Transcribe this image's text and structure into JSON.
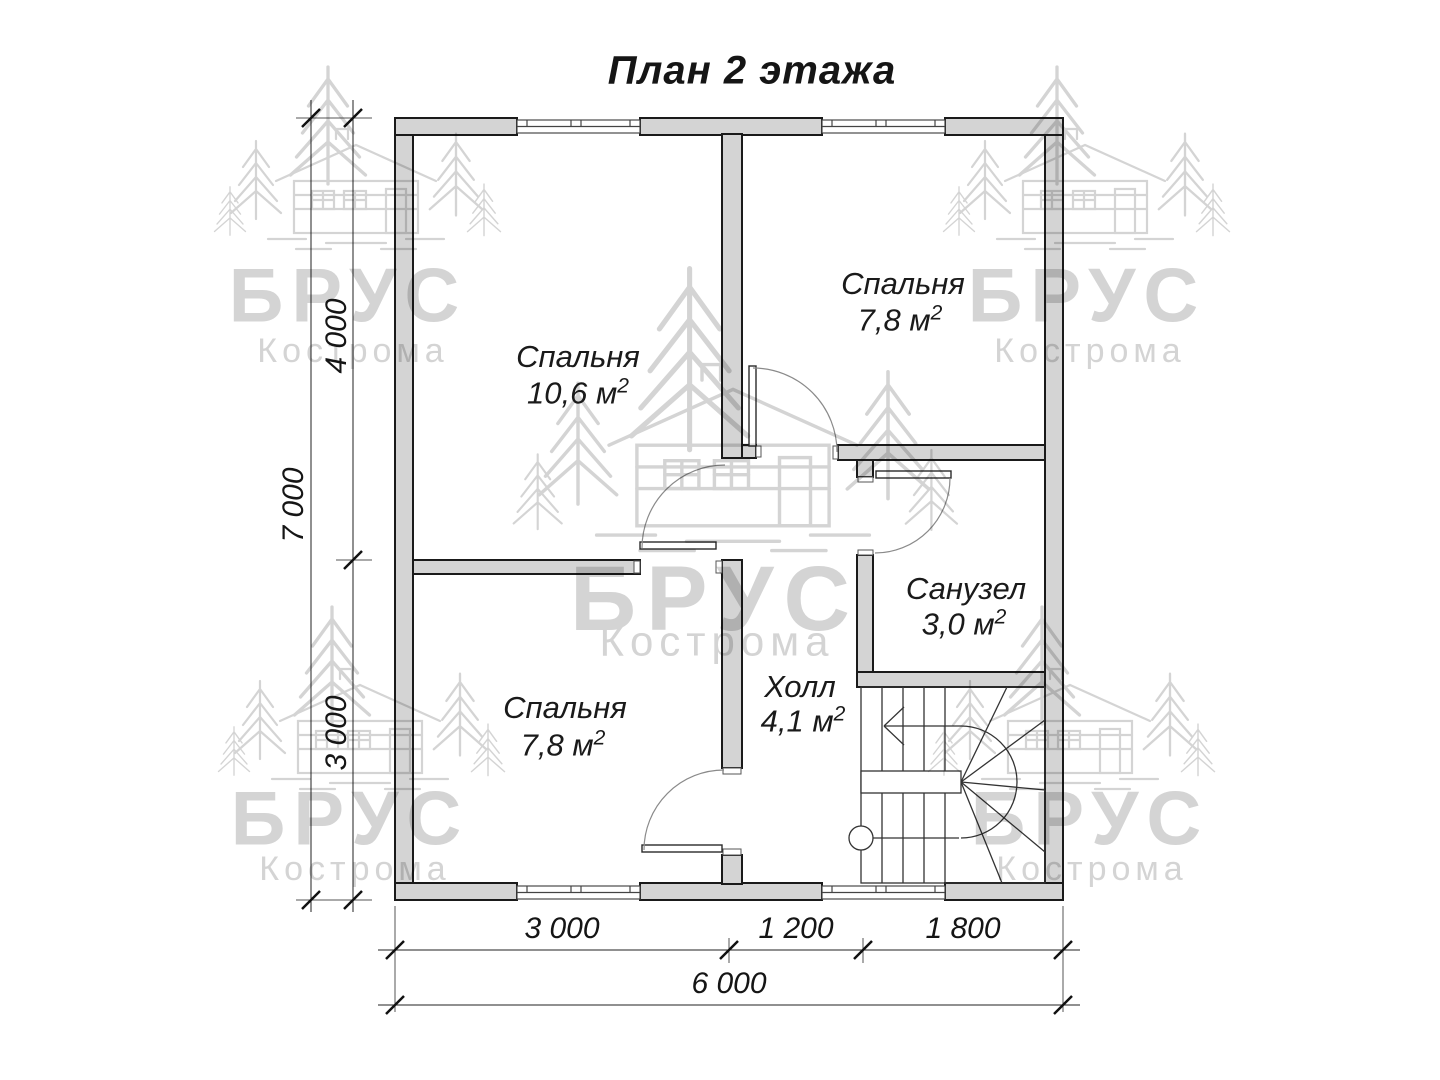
{
  "title": "План 2 этажа",
  "rooms": {
    "bedroom_main": {
      "name": "Спальня",
      "area": "10,6 м",
      "sup": "2"
    },
    "bedroom_top_right": {
      "name": "Спальня",
      "area": "7,8 м",
      "sup": "2"
    },
    "bedroom_bottom_left": {
      "name": "Спальня",
      "area": "7,8 м",
      "sup": "2"
    },
    "bathroom": {
      "name": "Санузел",
      "area": "3,0 м",
      "sup": "2"
    },
    "hall": {
      "name": "Холл",
      "area": "4,1 м",
      "sup": "2"
    }
  },
  "dimensions": {
    "left_total": "7 000",
    "left_upper": "4 000",
    "left_lower": "3 000",
    "bottom_left": "3 000",
    "bottom_middle": "1 200",
    "bottom_right": "1 800",
    "bottom_total": "6 000"
  },
  "watermark": {
    "brand": "БРУС",
    "city": "Кострома"
  },
  "colors": {
    "wall_fill": "#d4d4d4",
    "line": "#1a1a1a",
    "watermark": "#d4d4d4",
    "background": "#ffffff"
  }
}
